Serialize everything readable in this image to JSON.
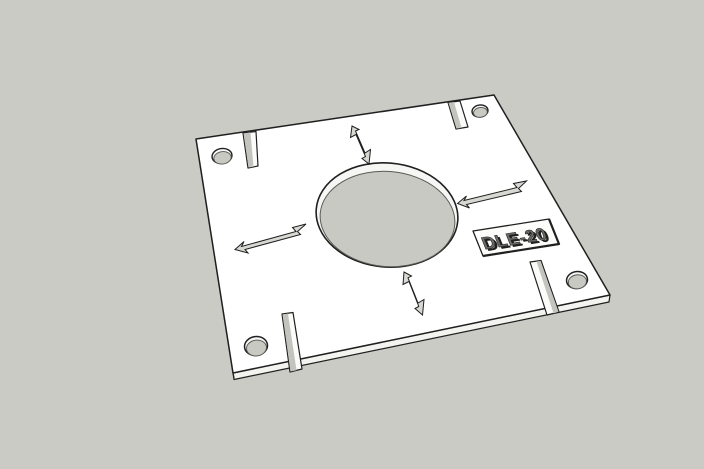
{
  "viewport": {
    "background_color": "#cbcbc5",
    "label": {
      "text": "DLE-20"
    },
    "colors": {
      "face": "#ffffff",
      "edge": "#202020",
      "side_face": "#f3f3f0",
      "hole_wall": "#f6f6f4",
      "hole_interior": "#c9c9c3",
      "slot_face": "#fbfbf9",
      "slot_wall": "#c4c4bf",
      "mark_fill": "#d8d8d3",
      "plaque_face": "#fdfdfb",
      "label_face": "#6a6a66",
      "label_extrusion": "#202020",
      "label_highlight": "#fafaf8"
    }
  }
}
